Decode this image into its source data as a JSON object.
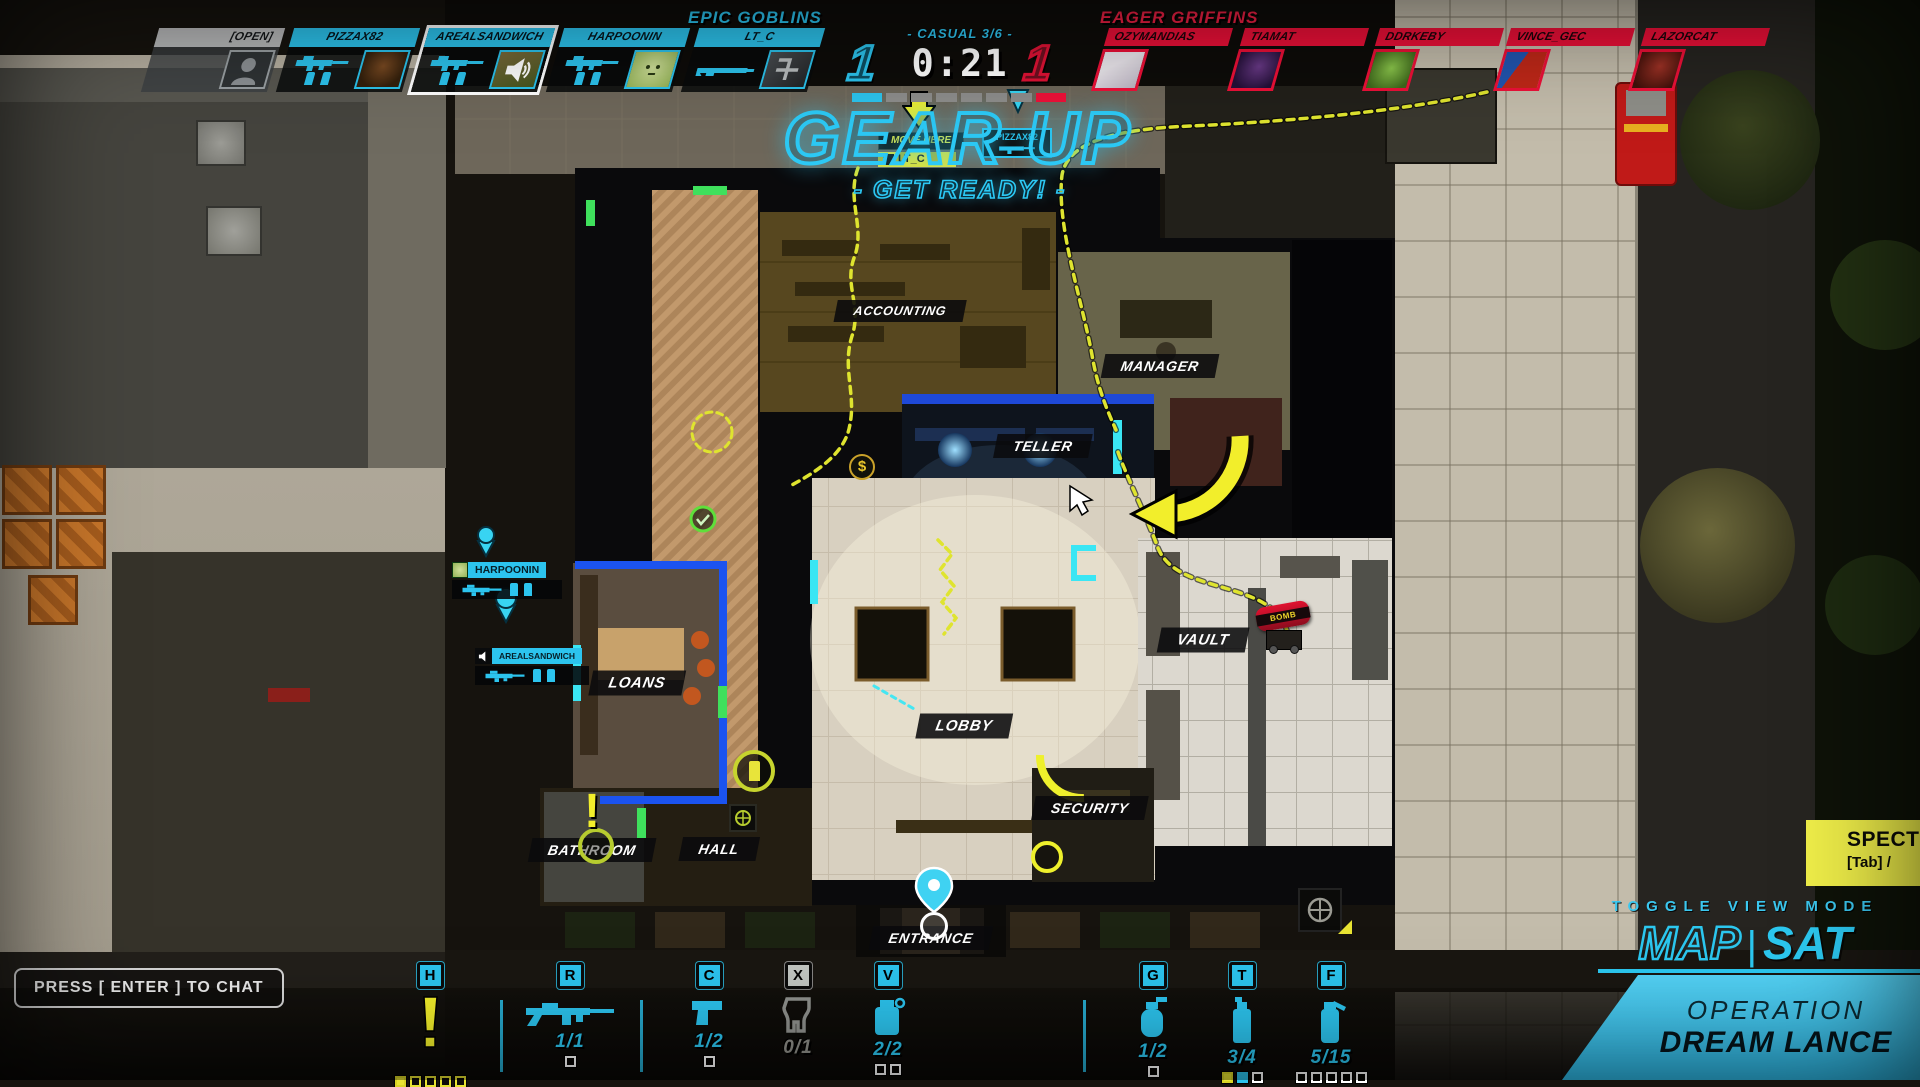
{
  "match": {
    "left_team": {
      "name": "EPIC GOBLINS",
      "score": "1"
    },
    "right_team": {
      "name": "EAGER GRIFFINS",
      "score": "1"
    },
    "mode": "- CASUAL 3/6 -",
    "timer": "0:21",
    "round_pips": [
      "c",
      "g",
      "g",
      "g",
      "g",
      "g",
      "g",
      "r"
    ]
  },
  "left_players": [
    {
      "name": "[OPEN]"
    },
    {
      "name": "PIZZAX82"
    },
    {
      "name": "AREALSANDWICH"
    },
    {
      "name": "HARPOONIN"
    },
    {
      "name": "LT_C"
    }
  ],
  "right_players": [
    {
      "name": "OZYMANDIAS"
    },
    {
      "name": "TIAMAT"
    },
    {
      "name": "DDRKEBY"
    },
    {
      "name": "VINCE_GEC"
    },
    {
      "name": "LAZORCAT"
    }
  ],
  "announcement": {
    "title": "GEAR UP",
    "subtitle": "- GET READY! -"
  },
  "map": {
    "rooms": [
      {
        "name": "ACCOUNTING"
      },
      {
        "name": "MANAGER"
      },
      {
        "name": "TELLER"
      },
      {
        "name": "VAULT"
      },
      {
        "name": "LOANS"
      },
      {
        "name": "LOBBY"
      },
      {
        "name": "SECURITY"
      },
      {
        "name": "BATHROOM"
      },
      {
        "name": "HALL"
      },
      {
        "name": "ENTRANCE"
      }
    ],
    "markers": {
      "move_here": "MOVE HERE",
      "lt_c_tag": "LT_C",
      "pizzax82_tag": "PIZZAX82",
      "harpoonin_tag": "HARPOONIN",
      "arealsandwich_tag": "AREALSANDWICH",
      "bomb_tag": "BOMB",
      "dollar": "$",
      "exclamation": "!"
    }
  },
  "hotbar": {
    "slots": [
      {
        "key": "H",
        "ammo": "",
        "pips": [
          "fy",
          "hy",
          "hy",
          "hy",
          "hy"
        ]
      },
      {
        "key": "R",
        "ammo": "1/1",
        "pips": [
          "hw"
        ]
      },
      {
        "key": "C",
        "ammo": "1/2",
        "pips": [
          "hw"
        ]
      },
      {
        "key": "X",
        "ammo": "0/1",
        "pips": []
      },
      {
        "key": "V",
        "ammo": "2/2",
        "pips": [
          "hw",
          "hw"
        ]
      },
      {
        "key": "G",
        "ammo": "1/2",
        "pips": [
          "hw"
        ]
      },
      {
        "key": "T",
        "ammo": "3/4",
        "pips": [
          "fy",
          "fc",
          "hw"
        ]
      },
      {
        "key": "F",
        "ammo": "5/15",
        "pips": [
          "hw",
          "hw",
          "hw",
          "hw",
          "hw"
        ]
      }
    ]
  },
  "panels": {
    "chat_prompt": "PRESS [ ENTER ] TO CHAT",
    "spectate_label": "SPECT",
    "spectate_key": "[Tab] /",
    "toggle_view_label": "TOGGLE VIEW MODE",
    "view_map": "MAP",
    "view_divider": "|",
    "view_sat": "SAT",
    "operation_line1": "OPERATION",
    "operation_line2": "DREAM LANCE"
  },
  "colors": {
    "accent_cyan": "#2cc4ee",
    "accent_red": "#ee1038",
    "accent_yellow": "#e8e433"
  }
}
